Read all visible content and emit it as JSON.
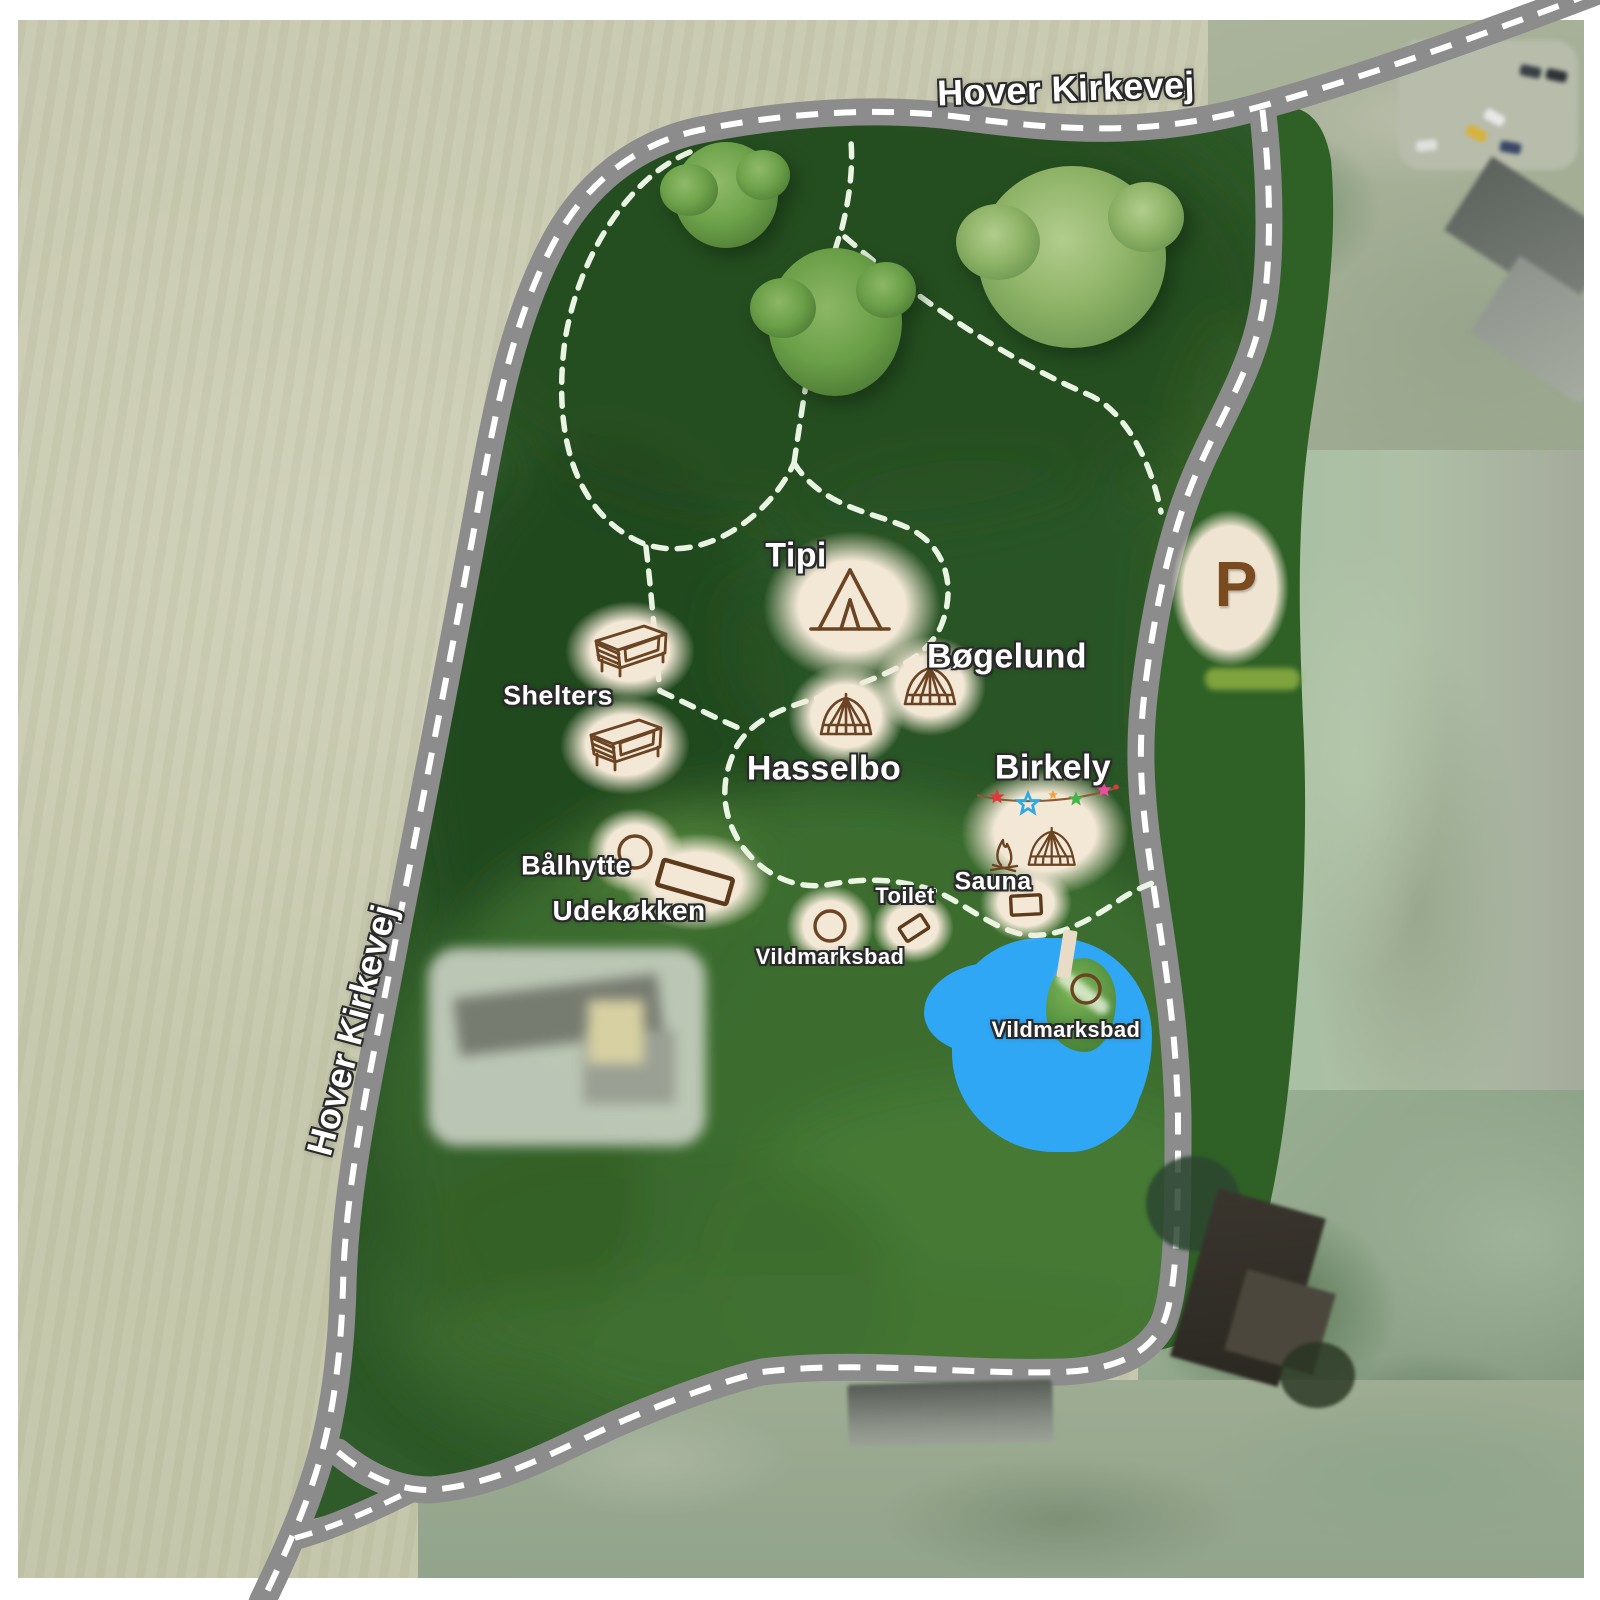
{
  "map": {
    "description": "Aerial overview map of a glamping campsite with marked accommodations, facilities, roads and walking trails",
    "background": "satellite-photo"
  },
  "roads": [
    {
      "position": "top",
      "label": "Hover Kirkevej"
    },
    {
      "position": "left",
      "label": "Hover Kirkevej"
    }
  ],
  "parking": {
    "label": "P",
    "icon": "parking-area"
  },
  "locations": [
    {
      "label": "Tipi",
      "icon": "tipi-tent-icon"
    },
    {
      "label": "Bøgelund",
      "icon": "bell-tent-icon"
    },
    {
      "label": "Hasselbo",
      "icon": "bell-tent-icon"
    },
    {
      "label": "Birkely",
      "icon": "bell-tent-campfire-bunting-icon"
    },
    {
      "label": "Shelters",
      "icon": "wooden-shelter-icon"
    },
    {
      "label": "Bålhytte",
      "icon": "circle-marker-icon"
    },
    {
      "label": "Udekøkken",
      "icon": "rectangle-marker-icon"
    },
    {
      "label": "Vildmarksbad",
      "icon": "hot-tub-circle-icon"
    },
    {
      "label": "Toilet",
      "icon": "rectangle-marker-icon"
    },
    {
      "label": "Sauna",
      "icon": "rectangle-marker-icon"
    },
    {
      "label": "Vildmarksbad",
      "icon": "hot-tub-circle-icon"
    }
  ],
  "features": {
    "lake": "blue pond with island, jetty and hot tub",
    "trees": "three large trees in northern meadow",
    "trails": "white dashed walking paths",
    "bunting_star_colors": [
      "#e03a3a",
      "#2fa9e0",
      "#f2a03c",
      "#43b649",
      "#ee4fa0"
    ]
  },
  "colors": {
    "road": "#8c8c8c",
    "road_dash": "#ffffff",
    "trail_dash": "#f0fae9",
    "site_green": "#2d5827",
    "splotch_cream": "#f3e8d6",
    "icon_brown": "#6b4423",
    "lake_blue": "#2fa7f4",
    "field_beige": "#c9cab2",
    "label_white": "#ffffff"
  }
}
